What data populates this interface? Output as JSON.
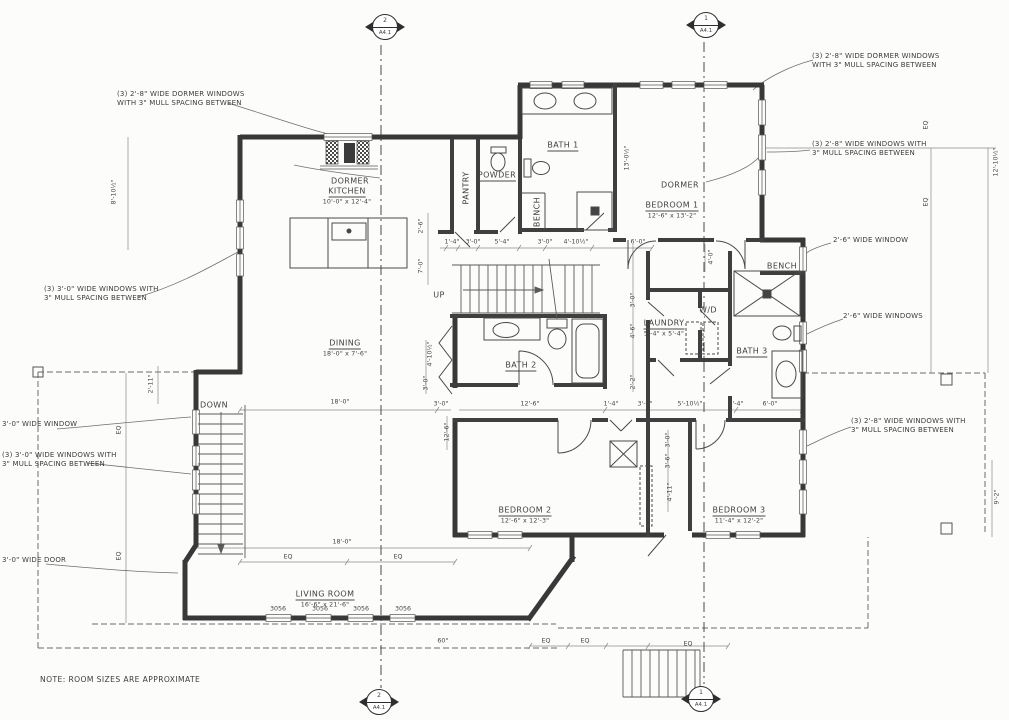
{
  "note": "NOTE: ROOM SIZES ARE APPROXIMATE",
  "colors": {
    "ink": "#3a3a3a",
    "paper": "#fcfcfa",
    "dim": "#777777"
  },
  "section_markers": [
    {
      "num": "2",
      "sheet": "A4.1",
      "x": 385,
      "y": 27
    },
    {
      "num": "1",
      "sheet": "A4.1",
      "x": 706,
      "y": 25
    },
    {
      "num": "2",
      "sheet": "A4.1",
      "x": 379,
      "y": 702
    },
    {
      "num": "1",
      "sheet": "A4.1",
      "x": 701,
      "y": 699
    }
  ],
  "rooms": [
    {
      "label": "DORMER",
      "x": 350,
      "y": 178
    },
    {
      "label": "KITCHEN",
      "size": "10'-0\" x 12'-4\"",
      "ul": true,
      "x": 347,
      "y": 192
    },
    {
      "label": "PANTRY",
      "rot": true,
      "x": 463,
      "y": 188
    },
    {
      "label": "POWDER",
      "ul": true,
      "x": 497,
      "y": 172
    },
    {
      "label": "BATH 1",
      "ul": true,
      "x": 563,
      "y": 142
    },
    {
      "label": "BENCH",
      "rot": true,
      "x": 534,
      "y": 212
    },
    {
      "label": "DORMER",
      "x": 680,
      "y": 182
    },
    {
      "label": "BEDROOM 1",
      "size": "12'-6\" x 13'-2\"",
      "ul": true,
      "x": 672,
      "y": 206
    },
    {
      "label": "DINING",
      "size": "18'-0\" x 7'-6\"",
      "ul": true,
      "x": 345,
      "y": 344
    },
    {
      "label": "UP",
      "x": 439,
      "y": 292
    },
    {
      "label": "BATH 2",
      "ul": true,
      "x": 521,
      "y": 362
    },
    {
      "label": "DOWN",
      "x": 214,
      "y": 402
    },
    {
      "label": "LAUNDRY",
      "size": "5'-4\" x 5'-4\"",
      "ul": true,
      "x": 664,
      "y": 324
    },
    {
      "label": "W/D",
      "x": 708,
      "y": 307
    },
    {
      "label": "BENCH",
      "x": 782,
      "y": 263
    },
    {
      "label": "BATH 3",
      "ul": true,
      "x": 752,
      "y": 348
    },
    {
      "label": "BEDROOM 2",
      "size": "12'-6\" x 12'-3\"",
      "ul": true,
      "x": 525,
      "y": 511
    },
    {
      "label": "BEDROOM 3",
      "size": "11'-4\" x 12'-2\"",
      "ul": true,
      "x": 739,
      "y": 511
    },
    {
      "label": "LIVING ROOM",
      "size": "16'-6\" x 21'-6\"",
      "ul": true,
      "x": 325,
      "y": 595
    }
  ],
  "annotations": [
    {
      "text": "(3) 2'-8\" WIDE DORMER WINDOWS\nWITH 3\" MULL SPACING BETWEEN",
      "x": 117,
      "y": 90
    },
    {
      "text": "(3) 2'-8\" WIDE DORMER WINDOWS\nWITH 3\" MULL SPACING BETWEEN",
      "x": 812,
      "y": 52
    },
    {
      "text": "(3) 2'-8\" WIDE WINDOWS WITH\n3\" MULL SPACING BETWEEN",
      "x": 812,
      "y": 140
    },
    {
      "text": "2'-6\" WIDE WINDOW",
      "x": 833,
      "y": 236
    },
    {
      "text": "2'-6\" WIDE WINDOWS",
      "x": 843,
      "y": 312
    },
    {
      "text": "(3) 2'-8\" WIDE WINDOWS WITH\n3\" MULL SPACING BETWEEN",
      "x": 851,
      "y": 417
    },
    {
      "text": "(3) 3'-0\" WIDE WINDOWS WITH\n3\" MULL SPACING BETWEEN",
      "x": 44,
      "y": 285
    },
    {
      "text": "3'-0\" WIDE WINDOW",
      "x": 2,
      "y": 420
    },
    {
      "text": "(3) 3'-0\" WIDE WINDOWS WITH\n3\" MULL SPACING BETWEEN",
      "x": 2,
      "y": 451
    },
    {
      "text": "3'-0\" WIDE DOOR",
      "x": 2,
      "y": 556
    }
  ],
  "dims": [
    {
      "t": "8'-10½\"",
      "x": 114,
      "y": 192,
      "r": 1
    },
    {
      "t": "EQ",
      "x": 119,
      "y": 430,
      "r": 1
    },
    {
      "t": "EQ",
      "x": 119,
      "y": 556,
      "r": 1
    },
    {
      "t": "2'-11\"",
      "x": 151,
      "y": 384,
      "r": 1
    },
    {
      "t": "EQ",
      "x": 926,
      "y": 125,
      "r": 1
    },
    {
      "t": "EQ",
      "x": 926,
      "y": 202,
      "r": 1
    },
    {
      "t": "12'-10½\"",
      "x": 996,
      "y": 162,
      "r": 1
    },
    {
      "t": "13'-0½\"",
      "x": 627,
      "y": 158,
      "r": 1
    },
    {
      "t": "2'-6\"",
      "x": 421,
      "y": 226,
      "r": 1
    },
    {
      "t": "7'-0\"",
      "x": 421,
      "y": 266,
      "r": 1
    },
    {
      "t": "1'-4\"",
      "x": 452,
      "y": 242
    },
    {
      "t": "3'-0\"",
      "x": 473,
      "y": 242
    },
    {
      "t": "5'-4\"",
      "x": 502,
      "y": 242
    },
    {
      "t": "3'-0\"",
      "x": 545,
      "y": 242
    },
    {
      "t": "4'-10½\"",
      "x": 576,
      "y": 242
    },
    {
      "t": "6'-0\"",
      "x": 638,
      "y": 242
    },
    {
      "t": "4'-0\"",
      "x": 711,
      "y": 257,
      "r": 1
    },
    {
      "t": "4'-10½\"",
      "x": 430,
      "y": 354,
      "r": 1
    },
    {
      "t": "3'-0\"",
      "x": 426,
      "y": 383,
      "r": 1
    },
    {
      "t": "3'-0\"",
      "x": 633,
      "y": 300,
      "r": 1
    },
    {
      "t": "4'-6\"",
      "x": 633,
      "y": 331,
      "r": 1
    },
    {
      "t": "2'-2\"",
      "x": 633,
      "y": 382,
      "r": 1
    },
    {
      "t": "3'-0\"",
      "x": 441,
      "y": 404
    },
    {
      "t": "12'-6\"",
      "x": 530,
      "y": 404
    },
    {
      "t": "1'-4\"",
      "x": 611,
      "y": 404
    },
    {
      "t": "3'-0\"",
      "x": 645,
      "y": 404
    },
    {
      "t": "5'-10½\"",
      "x": 690,
      "y": 404
    },
    {
      "t": "1'-4\"",
      "x": 736,
      "y": 404
    },
    {
      "t": "6'-0\"",
      "x": 770,
      "y": 404
    },
    {
      "t": "18'-0\"",
      "x": 340,
      "y": 402
    },
    {
      "t": "18'-0\"",
      "x": 342,
      "y": 542
    },
    {
      "t": "12'-6\"",
      "x": 447,
      "y": 432,
      "r": 1
    },
    {
      "t": "3'-0\"",
      "x": 668,
      "y": 440,
      "r": 1
    },
    {
      "t": "3'-6\"",
      "x": 668,
      "y": 461,
      "r": 1
    },
    {
      "t": "4'-11\"",
      "x": 670,
      "y": 492,
      "r": 1
    },
    {
      "t": "EQ",
      "x": 288,
      "y": 557
    },
    {
      "t": "EQ",
      "x": 398,
      "y": 557
    },
    {
      "t": "3056",
      "x": 278,
      "y": 609
    },
    {
      "t": "3056",
      "x": 320,
      "y": 609
    },
    {
      "t": "3056",
      "x": 361,
      "y": 609
    },
    {
      "t": "3056",
      "x": 403,
      "y": 609
    },
    {
      "t": "60°",
      "x": 443,
      "y": 641
    },
    {
      "t": "EQ",
      "x": 546,
      "y": 641
    },
    {
      "t": "EQ",
      "x": 585,
      "y": 641
    },
    {
      "t": "EQ",
      "x": 688,
      "y": 644
    },
    {
      "t": "9'-2\"",
      "x": 997,
      "y": 497,
      "r": 1
    }
  ]
}
